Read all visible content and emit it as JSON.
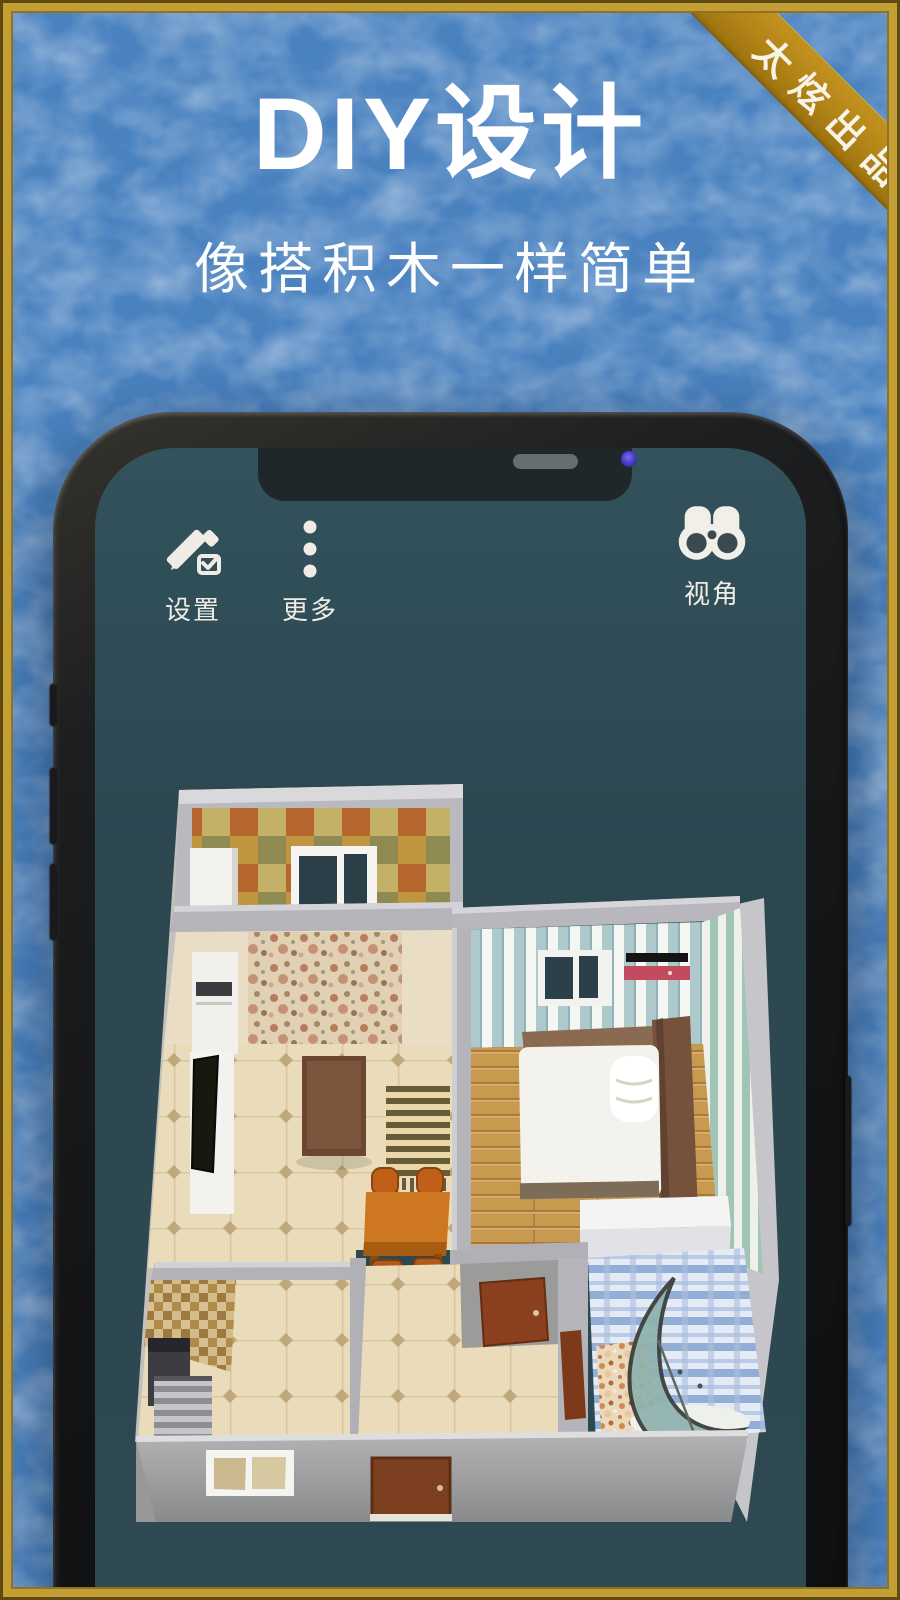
{
  "poster": {
    "title": "DIY设计",
    "subtitle": "像搭积木一样简单",
    "corner_ribbon": "太炫出品"
  },
  "app_screen": {
    "toolbar": [
      {
        "label": "设置",
        "icon": "pencil-edit-icon"
      },
      {
        "label": "更多",
        "icon": "more-dots-icon"
      },
      {
        "label": "视角",
        "icon": "binoculars-icon"
      }
    ],
    "floorplan_rooms": [
      "balcony",
      "living-room",
      "bedroom",
      "kitchen",
      "hallway",
      "bathroom"
    ]
  },
  "colors": {
    "background_blue": "#4a82c0",
    "frame_gold": "#c39e34",
    "ribbon_gold": "#b18316",
    "screen_teal": "#2e4851",
    "text_white": "#ffffff",
    "wall_gray": "#b7b7bd",
    "wood_floor": "#c79a50",
    "ac_red": "#c44a60"
  }
}
